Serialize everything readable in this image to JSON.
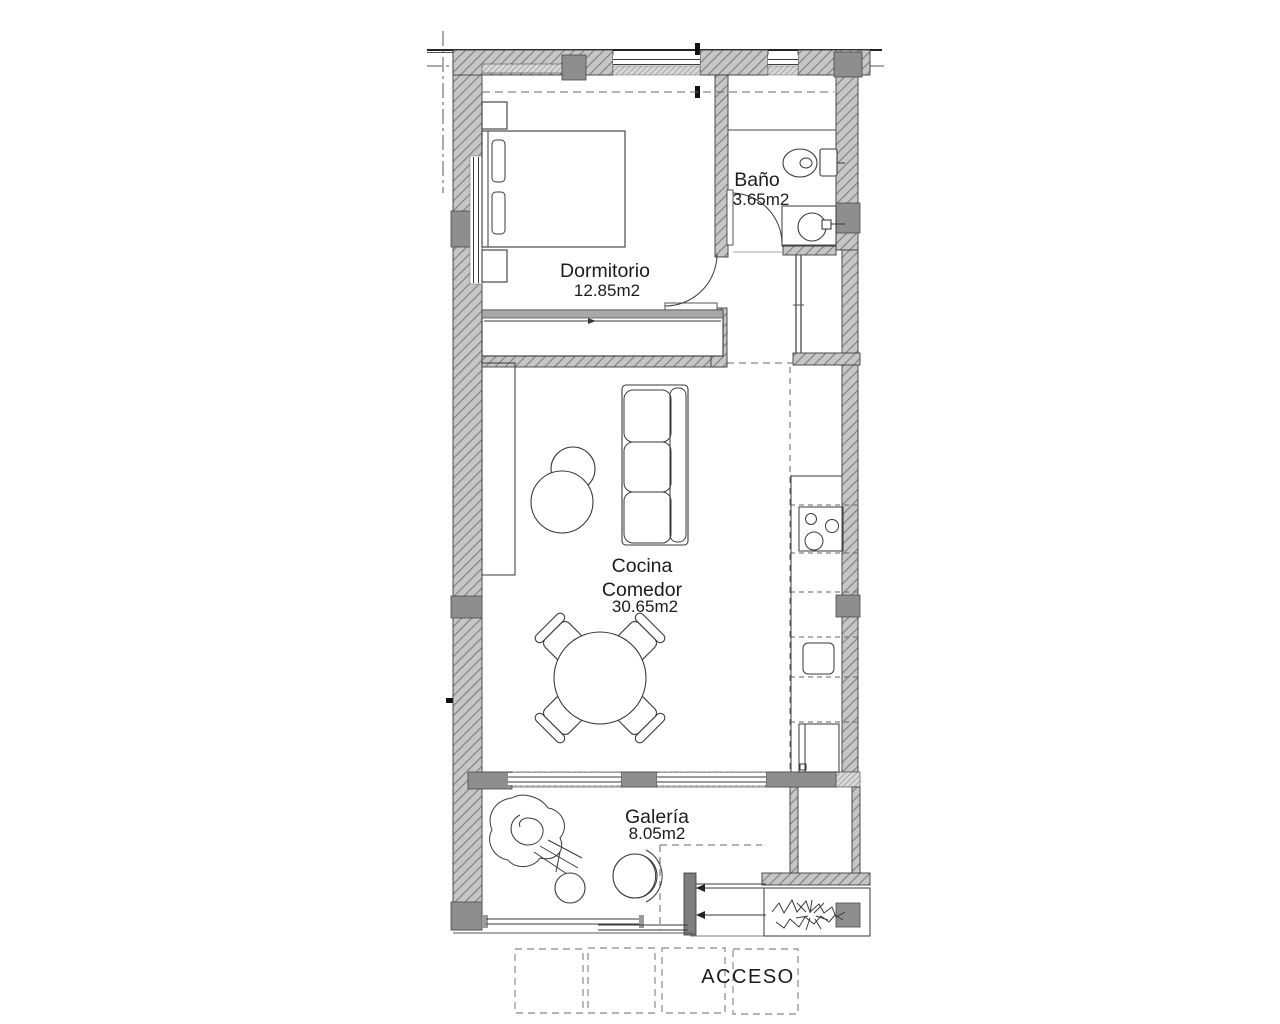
{
  "floor_plan": {
    "rooms": {
      "dormitorio": {
        "name": "Dormitorio",
        "area": "12.85m2"
      },
      "bano": {
        "name": "Baño",
        "area": "3.65m2"
      },
      "cocina_comedor": {
        "name_line1": "Cocina",
        "name_line2": "Comedor",
        "area": "30.65m2"
      },
      "galeria": {
        "name": "Galería",
        "area": "8.05m2"
      }
    },
    "entrance_label": "ACCESO",
    "colors": {
      "background": "#ffffff",
      "wall_fill": "#c6c6c6",
      "wall_hatch": "#828282",
      "pillar": "#8e8e8e",
      "line": "#2e2e2e",
      "text": "#1c1c1c"
    }
  }
}
